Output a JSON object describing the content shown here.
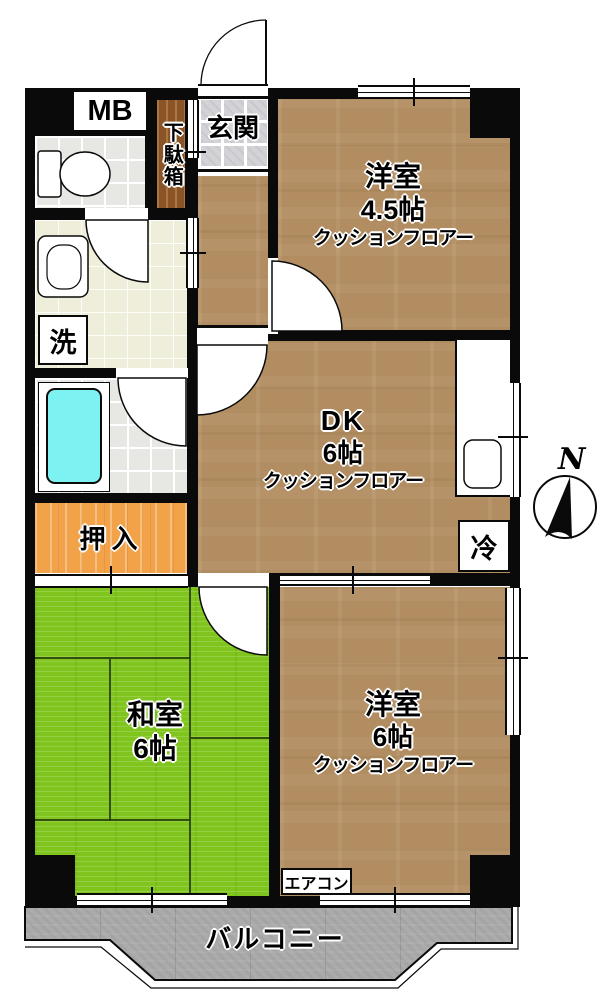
{
  "plan": {
    "meter_box_label": "MB",
    "shoe_cabinet_label": "下駄箱",
    "entrance_label": "玄関",
    "laundry_label": "洗",
    "refrigerator_label": "冷",
    "closet_label": "押入",
    "air_conditioner_label": "エアコン",
    "balcony_label": "バルコニー",
    "compass_north_label": "N",
    "rooms": {
      "western_room_small": {
        "name": "洋室",
        "size": "4.5帖",
        "floor_type": "クッションフロアー"
      },
      "dining_kitchen": {
        "name": "DK",
        "size": "6帖",
        "floor_type": "クッションフロアー"
      },
      "japanese_room": {
        "name": "和室",
        "size": "6帖"
      },
      "western_room_large": {
        "name": "洋室",
        "size": "6帖",
        "floor_type": "クッションフロアー"
      }
    },
    "colors": {
      "wall": "#0a0a0a",
      "wood_floor": "#b18d61",
      "tatami_green": "#80c41e",
      "closet_orange": "#f2a34a",
      "bathtub_cyan": "#7df2f2",
      "balcony_gray": "#ababab",
      "entrance_tile": "#d3d3d7",
      "wet_area_floor": "#efeeda",
      "tile_floor": "#e7e7e3",
      "shoe_cabinet_wood": "#8a5426"
    }
  }
}
